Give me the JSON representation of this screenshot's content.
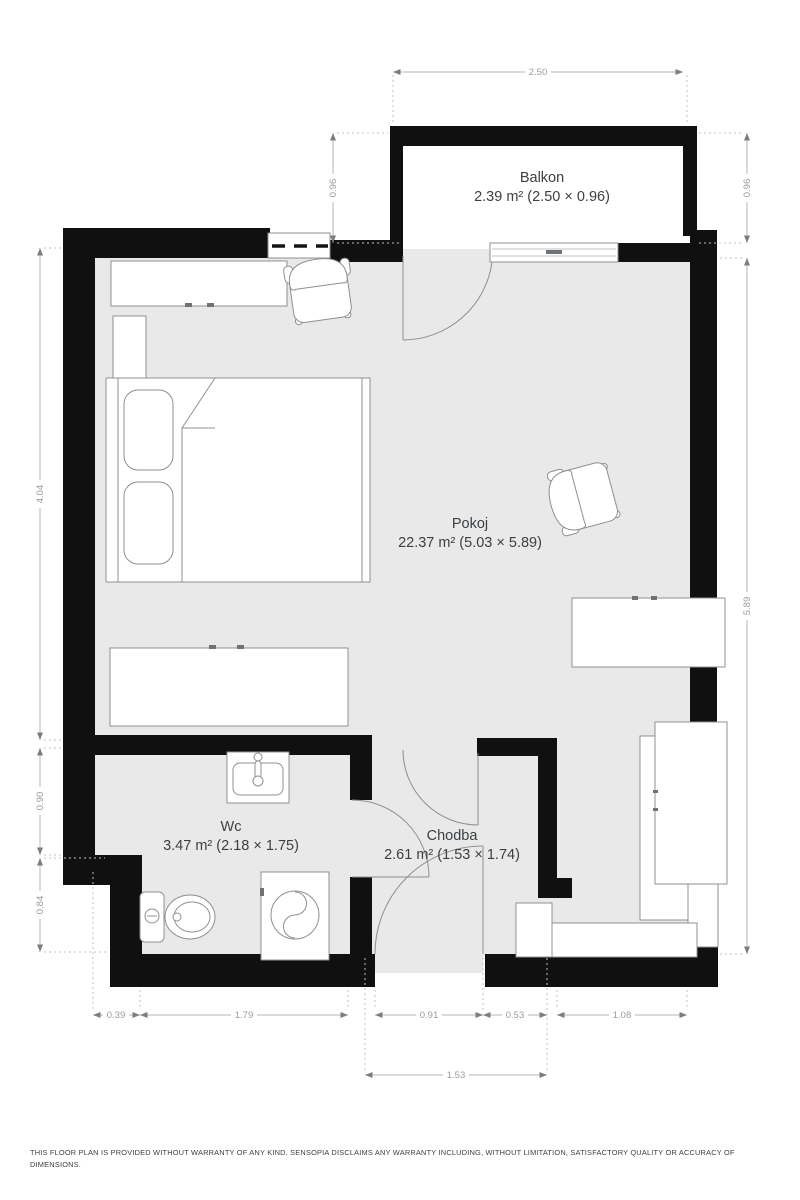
{
  "floor_plan": {
    "rooms": [
      {
        "name": "Balkon",
        "area": "2.39 m² (2.50 × 0.96)"
      },
      {
        "name": "Pokoj",
        "area": "22.37 m² (5.03 × 5.89)"
      },
      {
        "name": "Wc",
        "area": "3.47 m² (2.18 × 1.75)"
      },
      {
        "name": "Chodba",
        "area": "2.61 m² (1.53 × 1.74)"
      }
    ],
    "dimensions": {
      "top_width": "2.50",
      "balcony_depth_left": "0.96",
      "balcony_depth_right": "0.96",
      "right_height": "5.89",
      "left_upper": "4.04",
      "left_middle": "0.90",
      "left_lower": "0.84",
      "bottom_offset": "0.39",
      "bottom_wc_width": "1.79",
      "bottom_entrance": "0.91",
      "bottom_mid": "0.53",
      "bottom_right": "1.08",
      "bottom_hall_width": "1.53"
    },
    "disclaimer_line1": "THIS FLOOR PLAN IS PROVIDED WITHOUT WARRANTY OF ANY KIND. SENSOPIA DISCLAIMS ANY WARRANTY INCLUDING, WITHOUT LIMITATION, SATISFACTORY QUALITY OR ACCURACY OF",
    "disclaimer_line2": "DIMENSIONS.",
    "colors": {
      "wall": "#101010",
      "floor": "#e9e9e9",
      "dimension_text": "#9b9b9b",
      "label_text": "#3c4043"
    }
  }
}
